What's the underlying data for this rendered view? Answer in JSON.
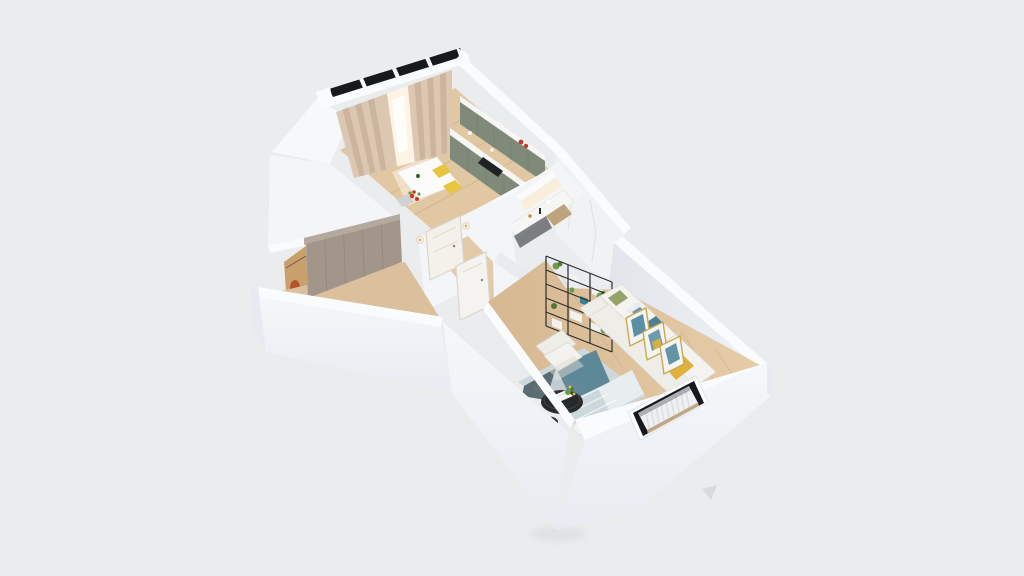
{
  "meta": {
    "kind": "3d-isometric-floorplan-render",
    "description": "Cutaway top-down 3D render of a T-shaped one-bedroom apartment on a plain light-gray backdrop. No visible text, UI chrome, labels or controls — a static architectural visualization image."
  },
  "palette": {
    "bg": "#ebeced",
    "wallBand": "#fafbfd",
    "wallFace": "#f3f5f8",
    "wallFaceShade": "#e7eaf0",
    "wallFaceDark": "#dde1e8",
    "wallInterior": "#e4e8ee",
    "wallInteriorLight": "#eef1f5",
    "marble": "#f1f2f4",
    "marbleVein": "#d8dadd",
    "wood": "#dcc09e",
    "woodLight": "#e9d2b0",
    "woodKitchen": "#e2c7a3",
    "plank": "#c6a57e",
    "curtain": "#dcc7b2",
    "curtainDark": "#ccb49d",
    "windowGlow": "#fdf4e3",
    "sage": "#7f8a7b",
    "sageDark": "#6d7a6c",
    "counter": "#f6f6f4",
    "cooktop": "#202224",
    "glass": "#17191c",
    "doorCream": "#f3f1ea",
    "doorWhite": "#f4f3f0",
    "doorFrame": "#d9d6cd",
    "sconce": "#e5b578",
    "wardrobe": "#a2958a",
    "wardrobeLight": "#b5a89c",
    "wardrobeSeam": "#8d8175",
    "warmLight": "#d89a5f",
    "clothes": "#b4542c",
    "sofa": "#efede8",
    "sofaShade": "#ddd9d1",
    "sofaBack": "#f4f3ef",
    "pillowGreen": "#97a468",
    "pillowTeal": "#4f7f96",
    "pillowYellow": "#e0b33c",
    "throw": "#dfb23c",
    "frameGold": "#c9a94f",
    "artTeal": "#3f7d94",
    "artWhite": "#f4f4f2",
    "rugBase": "#ccd8dc",
    "rugDark": "#5a6b72",
    "rugTeal": "#517f90",
    "rugLight": "#e8eef0",
    "tableBlack": "#28292b",
    "tableWhite": "#f3f3f1",
    "book": "#f7f7f5",
    "plant": "#6c9b4b",
    "plantDark": "#4e7a38",
    "shelfFrame": "#2c2d2f",
    "box": "#f2f2f0",
    "bookTeal": "#3f7d94",
    "radiator": "#eef0f2",
    "radiatorLine": "#d8dbdf",
    "chairYellow": "#e8c53c",
    "chairGray": "#cfd2d4",
    "flowerRed": "#c63a2e",
    "bottleRed": "#c23b30",
    "bottleGreen": "#3a5a33",
    "shadow": "#d3d6d9"
  },
  "scene": {
    "backdrop": "plain light gray studio background",
    "building": "white cutaway walls viewed from above at an angle; kitchen block top, hallway wing left, bathroom center, living room bottom right",
    "rooms": [
      {
        "name": "kitchen-dining",
        "position": "top block",
        "objects": [
          "balcony glazing strip with black frames",
          "beige floor-length curtains",
          "bright window between curtains",
          "sage-green upper cabinet run with white top",
          "sage-green base cabinet run with white counter",
          "black cooktop",
          "red bottles on counter end",
          "light oak floor",
          "white dining table",
          "two yellow chairs",
          "gray chair",
          "red flower centerpiece",
          "green bottle and glasses"
        ]
      },
      {
        "name": "hallway-wardrobe",
        "position": "left wing",
        "objects": [
          "taupe full-height wardrobe with door seams",
          "warm closet light",
          "orange hanging clothes",
          "oak floor strip"
        ]
      },
      {
        "name": "entry-corridor",
        "position": "center",
        "objects": [
          "cream entry door",
          "two warm wall sconces",
          "white interior door to living room",
          "oak floor"
        ]
      },
      {
        "name": "bathroom",
        "position": "center right",
        "objects": [
          "white marble wall with gray veining",
          "lit mirror cabinet with warm glow",
          "white vanity counter",
          "black faucet",
          "amber toiletry bottle",
          "dark under-counter niche",
          "wood vanity cabinet"
        ]
      },
      {
        "name": "living-room",
        "position": "bottom right block",
        "objects": [
          "black metal shelving unit with white boxes and green plants",
          "white fabric three-seat sofa",
          "green pillow",
          "patterned teal pillow",
          "teal-and-yellow pillow",
          "yellow throw blanket",
          "three gold-framed art prints leaning on wall",
          "white fabric armchair",
          "teal patterned area rug",
          "black round coffee table with white book, plant and yellow flowers",
          "small black stool table",
          "white round side table with plant",
          "exterior window with black frame",
          "white slatted radiator",
          "oak plank floor"
        ]
      }
    ]
  }
}
